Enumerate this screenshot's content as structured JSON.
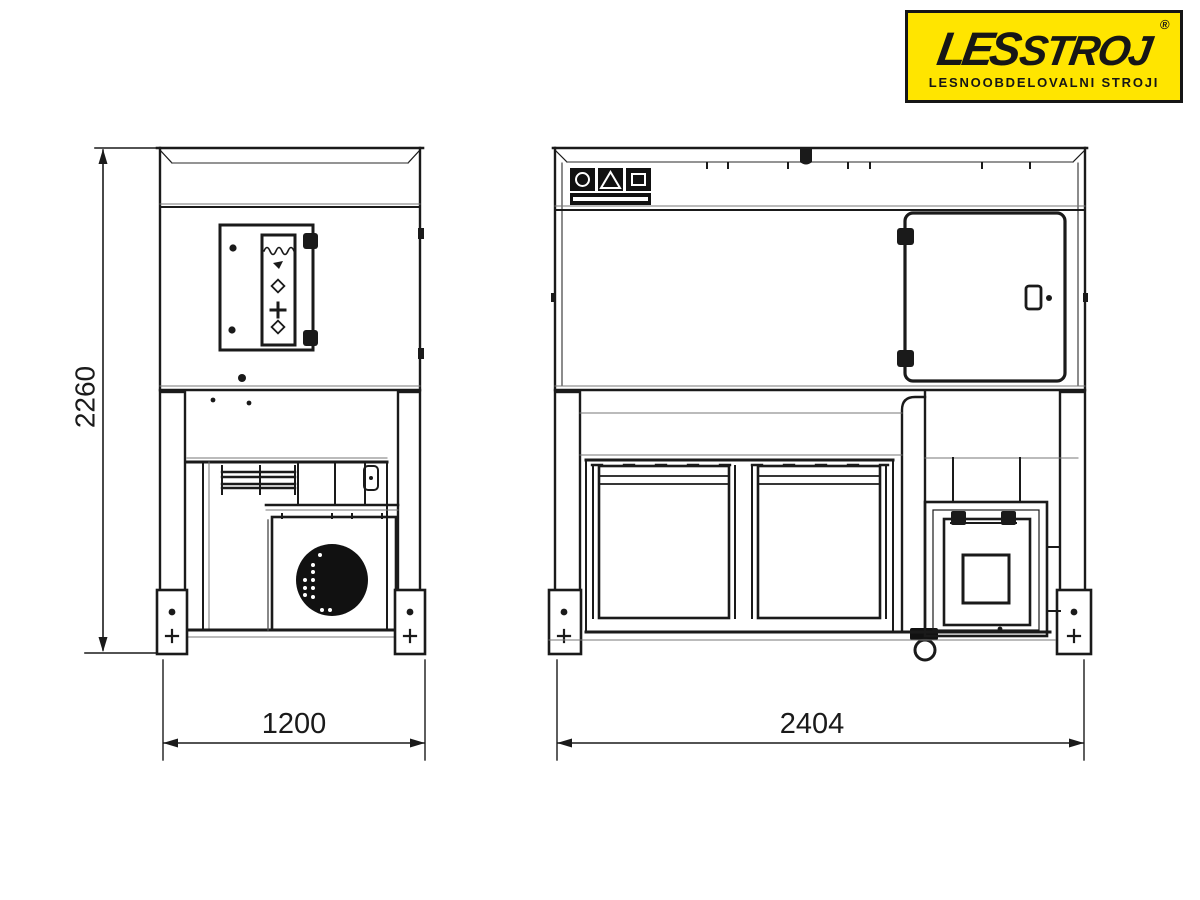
{
  "logo": {
    "brand_part1": "LES",
    "brand_part2": "STROJ",
    "registered_symbol": "®",
    "tagline": "LESNOOBDELOVALNI STROJI",
    "background_color": "#FFE500",
    "text_color": "#161616"
  },
  "drawing": {
    "line_color": "#1a1a1a",
    "dimensions": {
      "overall_height_mm": "2260",
      "side_view_width_mm": "1200",
      "front_view_width_mm": "2404"
    }
  }
}
